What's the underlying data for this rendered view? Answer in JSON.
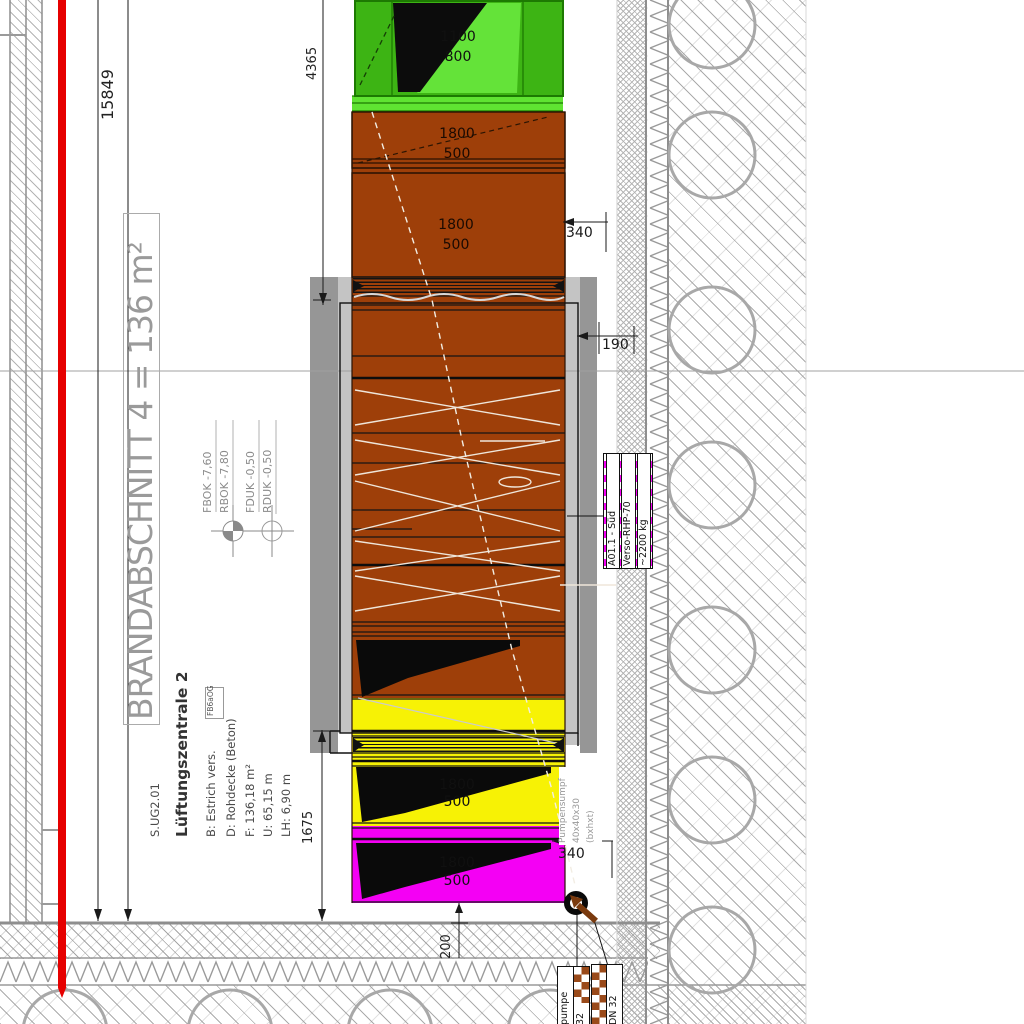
{
  "colors": {
    "fire_line_red": "#e60000",
    "duct_green": "#3db414",
    "duct_green_bright": "#64e339",
    "duct_brown": "#9e3f09",
    "duct_yellow": "#f7f205",
    "duct_magenta": "#f400f4",
    "slab_gray": "#969696",
    "slab_gray_light": "#c4c4c4",
    "checker_magenta": "#f400f4",
    "checker_brown": "#9a4a1a"
  },
  "fire_section": {
    "label": "BRANDABSCHNITT 4 = 136 m²"
  },
  "room": {
    "id": "S.UG2.01",
    "name": "Lüftungszentrale 2",
    "floor": "B: Estrich vers.",
    "floor_tag": "FB6aOG",
    "ceiling": "D: Rohdecke (Beton)",
    "area": "F: 136,18 m²",
    "perimeter": "U: 65,15 m",
    "height": "LH: 6,90 m"
  },
  "levels": {
    "fbok": "FBOK -7,60",
    "rbok": "RBOK -7,80",
    "fduk": "FDUK -0,50",
    "rduk": "RDUK -0,50"
  },
  "dims": {
    "total": "15849",
    "top": "4365",
    "duct_top": "340",
    "wall_gap": "190",
    "bottom_left": "1675",
    "duct_bottom": "340",
    "sump": "200"
  },
  "ducts": {
    "green": {
      "w": "1100",
      "h": "800"
    },
    "brown_upper": {
      "w": "1800",
      "h": "500"
    },
    "brown_mid": {
      "w": "1800",
      "h": "500"
    },
    "yellow": {
      "w": "1800",
      "h": "500"
    },
    "magenta": {
      "w": "1800",
      "h": "500"
    }
  },
  "unit_tag": {
    "line1": "A01.1 - Süd",
    "line2": "Verso-RHP-70",
    "line3": "~2200 kg"
  },
  "pump_note": {
    "line1": "Pumpensumpf",
    "line2": "40x40x30",
    "line3": "(bxhxt)"
  },
  "pump_tag": {
    "col1": "pumpe",
    "col2": "32"
  },
  "drain_tag": {
    "label": "DN 32"
  }
}
